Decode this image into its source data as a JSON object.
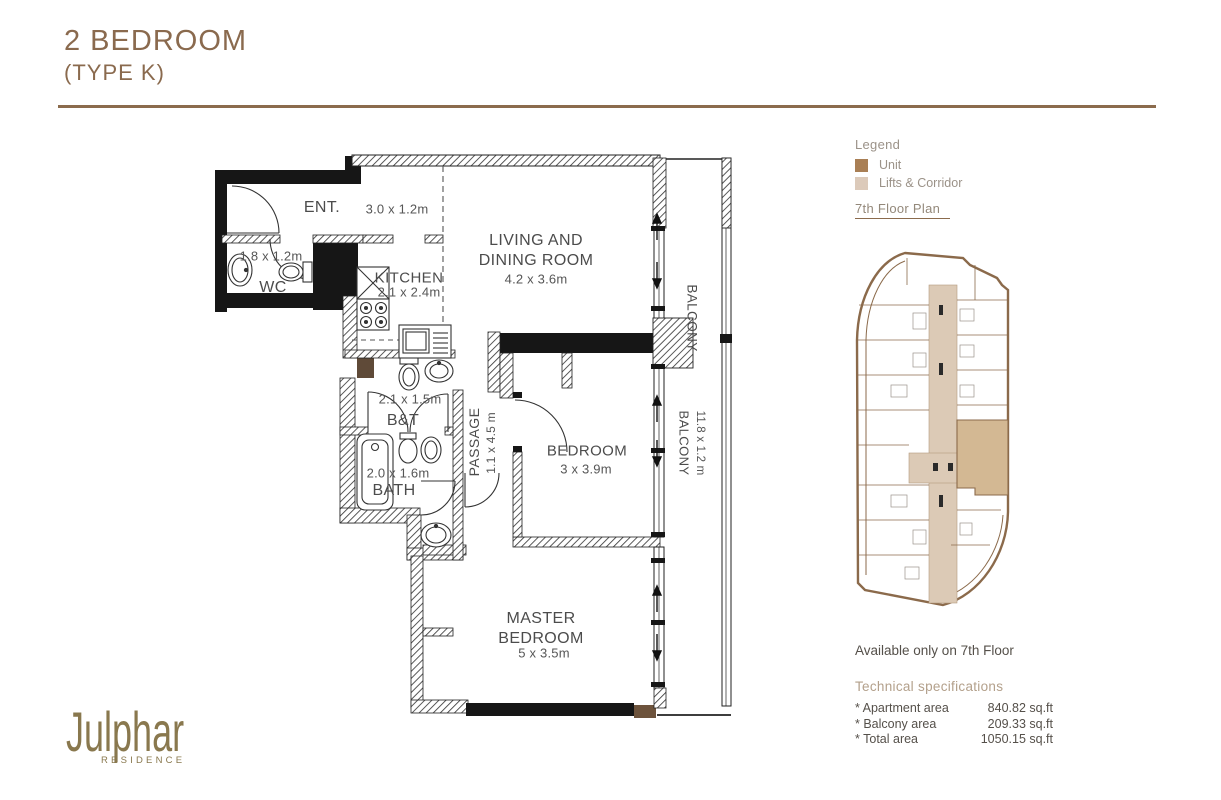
{
  "page": {
    "title_line1": "2 BEDROOM",
    "title_line2": "(TYPE K)"
  },
  "legend": {
    "heading": "Legend",
    "items": [
      {
        "label": "Unit",
        "color": "#a97f55"
      },
      {
        "label": "Lifts & Corridor",
        "color": "#dccaba"
      }
    ]
  },
  "floor_plan_link": "7th Floor Plan",
  "availability": "Available only on 7th Floor",
  "specs": {
    "heading": "Technical specifications",
    "rows": [
      {
        "label": "* Apartment area",
        "value": "840.82 sq.ft"
      },
      {
        "label": "* Balcony area",
        "value": "209.33 sq.ft"
      },
      {
        "label": "* Total area",
        "value": "1050.15 sq.ft"
      }
    ]
  },
  "logo": {
    "name": "Julphar",
    "sub": "RESIDENCE"
  },
  "plan": {
    "ent": {
      "name": "ENT.",
      "dims": "3.0 x 1.2m"
    },
    "wc": {
      "name": "WC",
      "dims": "1.8 x 1.2m"
    },
    "kitchen": {
      "name": "KITCHEN",
      "dims": "2.1 x 2.4m"
    },
    "living": {
      "line1": "LIVING AND",
      "line2": "DINING ROOM",
      "dims": "4.2 x 3.6m"
    },
    "bt": {
      "name": "B&T",
      "dims": "2.1 x 1.5m"
    },
    "bath": {
      "name": "BATH",
      "dims": "2.0 x 1.6m"
    },
    "passage": {
      "name": "PASSAGE",
      "dims": "1.1 x 4.5 m"
    },
    "bedroom": {
      "name": "BEDROOM",
      "dims": "3 x 3.9m"
    },
    "master": {
      "line1": "MASTER",
      "line2": "BEDROOM",
      "dims": "5 x 3.5m"
    },
    "balcony_upper": {
      "name": "BALCONY"
    },
    "balcony_lower": {
      "name": "BALCONY",
      "dims": "11.8 x 1.2 m"
    }
  }
}
